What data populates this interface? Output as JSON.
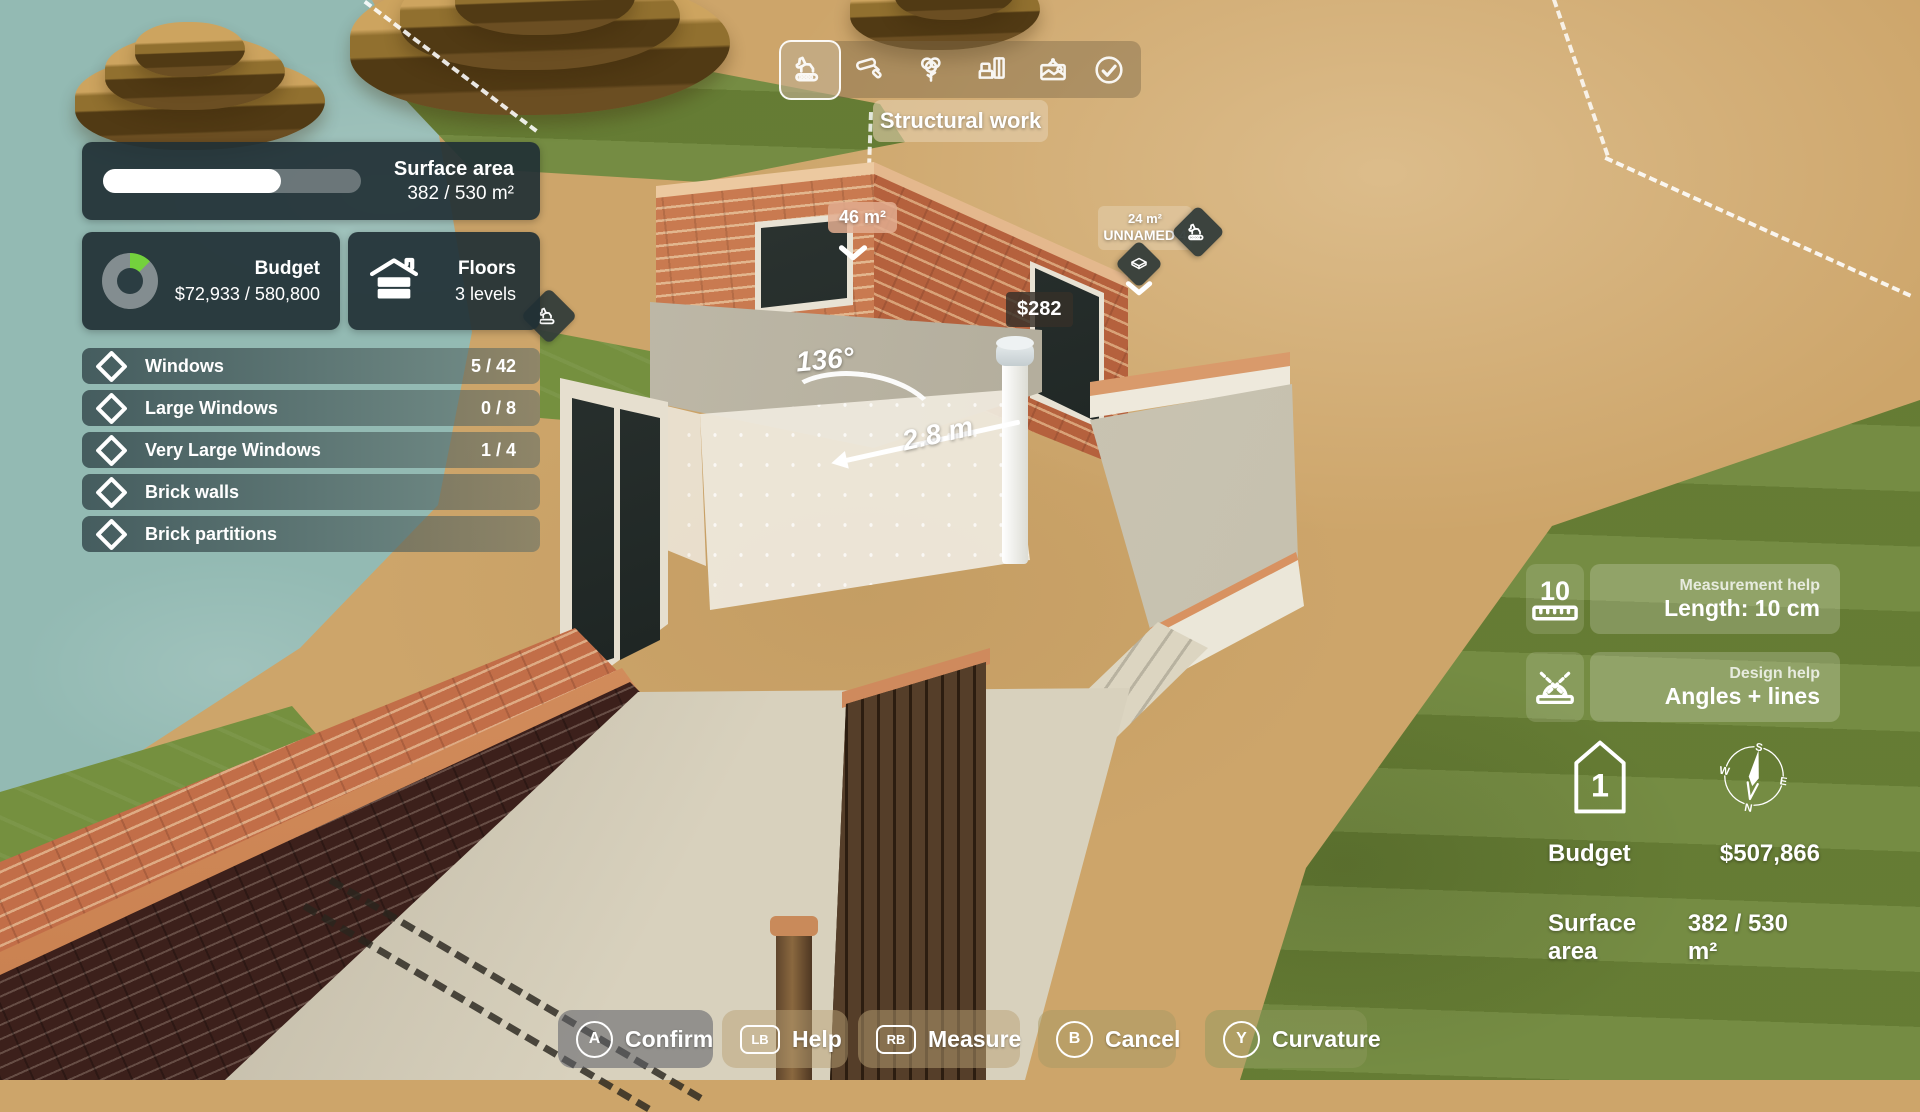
{
  "toolbar": {
    "active_tool_label": "Structural work",
    "tools": [
      {
        "name": "structural-work",
        "icon": "excavator-icon",
        "selected": true
      },
      {
        "name": "painting",
        "icon": "paint-roller-icon",
        "selected": false
      },
      {
        "name": "vegetation",
        "icon": "tree-icon",
        "selected": false
      },
      {
        "name": "furnishing",
        "icon": "furniture-icon",
        "selected": false
      },
      {
        "name": "decoration",
        "icon": "picture-frame-icon",
        "selected": false
      },
      {
        "name": "completion",
        "icon": "check-circle-icon",
        "selected": false
      }
    ]
  },
  "left_panel": {
    "surface_area": {
      "label": "Surface area",
      "value": "382 / 530 m²",
      "progress_pct": 69
    },
    "budget": {
      "label": "Budget",
      "value": "$72,933 / 580,800",
      "used_pct": 12.5,
      "donut_color": "#74d13d"
    },
    "floors": {
      "label": "Floors",
      "value": "3 levels"
    },
    "objectives": [
      {
        "label": "Windows",
        "count": "5 / 42"
      },
      {
        "label": "Large Windows",
        "count": "0 / 8"
      },
      {
        "label": "Very Large Windows",
        "count": "1 / 4"
      },
      {
        "label": "Brick walls",
        "count": ""
      },
      {
        "label": "Brick partitions",
        "count": ""
      }
    ]
  },
  "scene": {
    "area_tag": "46 m²",
    "cost_tag": "$282",
    "angle_label": "136°",
    "length_label": "2.8 m",
    "room_tag": {
      "area": "24 m²",
      "name": "UNNAMED 4"
    }
  },
  "right_panel": {
    "measurement_help": {
      "title": "Measurement help",
      "value": "Length: 10 cm",
      "ruler_value": "10"
    },
    "design_help": {
      "title": "Design help",
      "value": "Angles + lines"
    },
    "floor_level": "1",
    "compass": {
      "north": "N",
      "south": "S",
      "east": "E",
      "west": "W"
    },
    "budget": {
      "label": "Budget",
      "value": "$507,866"
    },
    "surface_area": {
      "label": "Surface area",
      "value": "382 / 530 m²"
    }
  },
  "action_bar": [
    {
      "button": "A",
      "label": "Confirm"
    },
    {
      "button": "LB",
      "label": "Help"
    },
    {
      "button": "RB",
      "label": "Measure"
    },
    {
      "button": "B",
      "label": "Cancel"
    },
    {
      "button": "Y",
      "label": "Curvature"
    }
  ],
  "colors": {
    "accent_green": "#74d13d",
    "panel_dark": "#213035",
    "terracotta": "#d68e5e",
    "grass": "#6e8639",
    "sand": "#cda56a",
    "water": "#93bab3",
    "brick": "#c26e48"
  }
}
